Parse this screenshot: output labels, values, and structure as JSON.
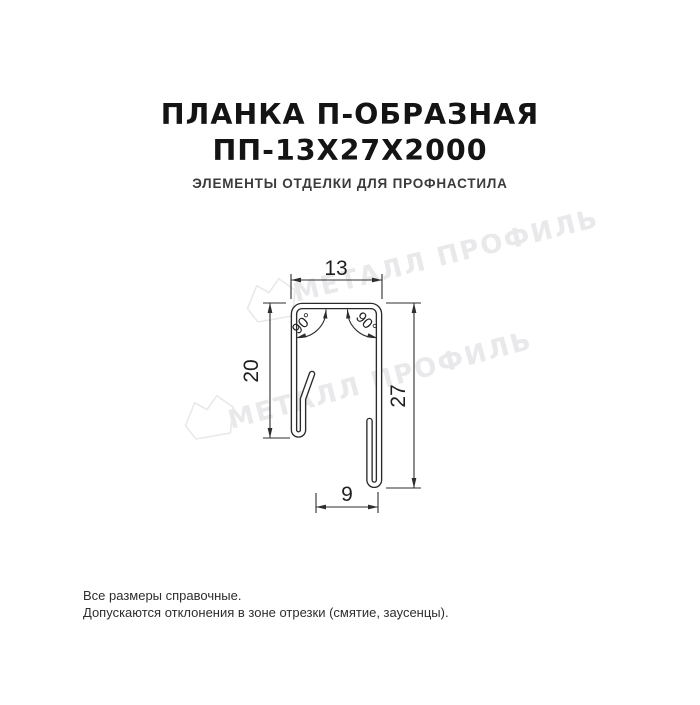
{
  "header": {
    "title_line1": "ПЛАНКА П-ОБРАЗНАЯ",
    "title_line2": "ПП-13Х27Х2000",
    "subtitle": "ЭЛЕМЕНТЫ ОТДЕЛКИ ДЛЯ ПРОФНАСТИЛА"
  },
  "drawing": {
    "dimensions": {
      "top_width": "13",
      "left_height": "20",
      "right_height": "27",
      "bottom_width": "9",
      "angle_left": "90°",
      "angle_right": "90°"
    }
  },
  "watermark": {
    "text": "МЕТАЛЛ ПРОФИЛЬ",
    "logo": "metall-profil-gem-icon"
  },
  "footer": {
    "note1": "Все размеры справочные.",
    "note2": "Допускаются отклонения в зоне отрезки (смятие, заусенцы)."
  },
  "colors": {
    "background": "#ffffff",
    "title": "#141414",
    "subtitle": "#3b3b3d",
    "drawing_line": "#2b2b2b",
    "watermark": "#e9e9ec"
  }
}
